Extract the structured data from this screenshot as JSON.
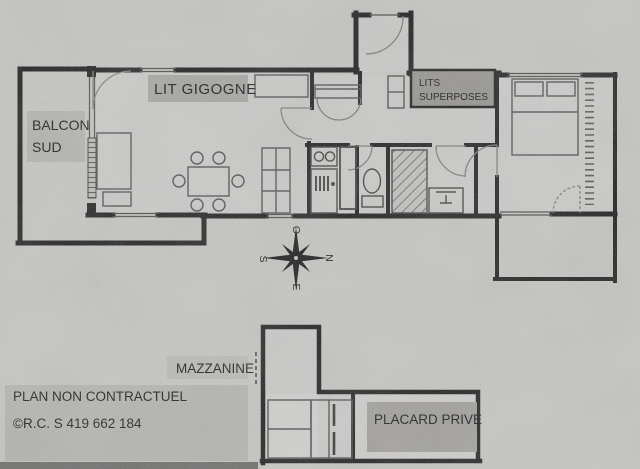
{
  "document": {
    "kind": "scanned apartment floor plan photo",
    "disclaimer": "PLAN NON CONTRACTUEL",
    "registration": "©R.C. S 419 662 184"
  },
  "labels": {
    "lit_gigogne": "LIT GIGOGNE",
    "balcon_line1": "BALCON",
    "balcon_line2": "SUD",
    "lits_line1": "LITS",
    "lits_line2": "SUPERPOSES",
    "mazzanine": "MAZZANINE",
    "placard": "PLACARD PRIVE"
  },
  "compass": {
    "west": "O",
    "south": "S",
    "north": "N",
    "east": "E"
  },
  "colors": {
    "paper": "#c7c6c3",
    "wall": "#1a1a1a",
    "furniture_line": "#4f4f4f",
    "label_box_light": "#b5b4b0",
    "label_box_medium": "#a7a6a3",
    "label_box_dark": "#96948f",
    "placard_box": "#a19f9c",
    "text": "#161616",
    "bottom_shadow": "#6b6a68"
  }
}
